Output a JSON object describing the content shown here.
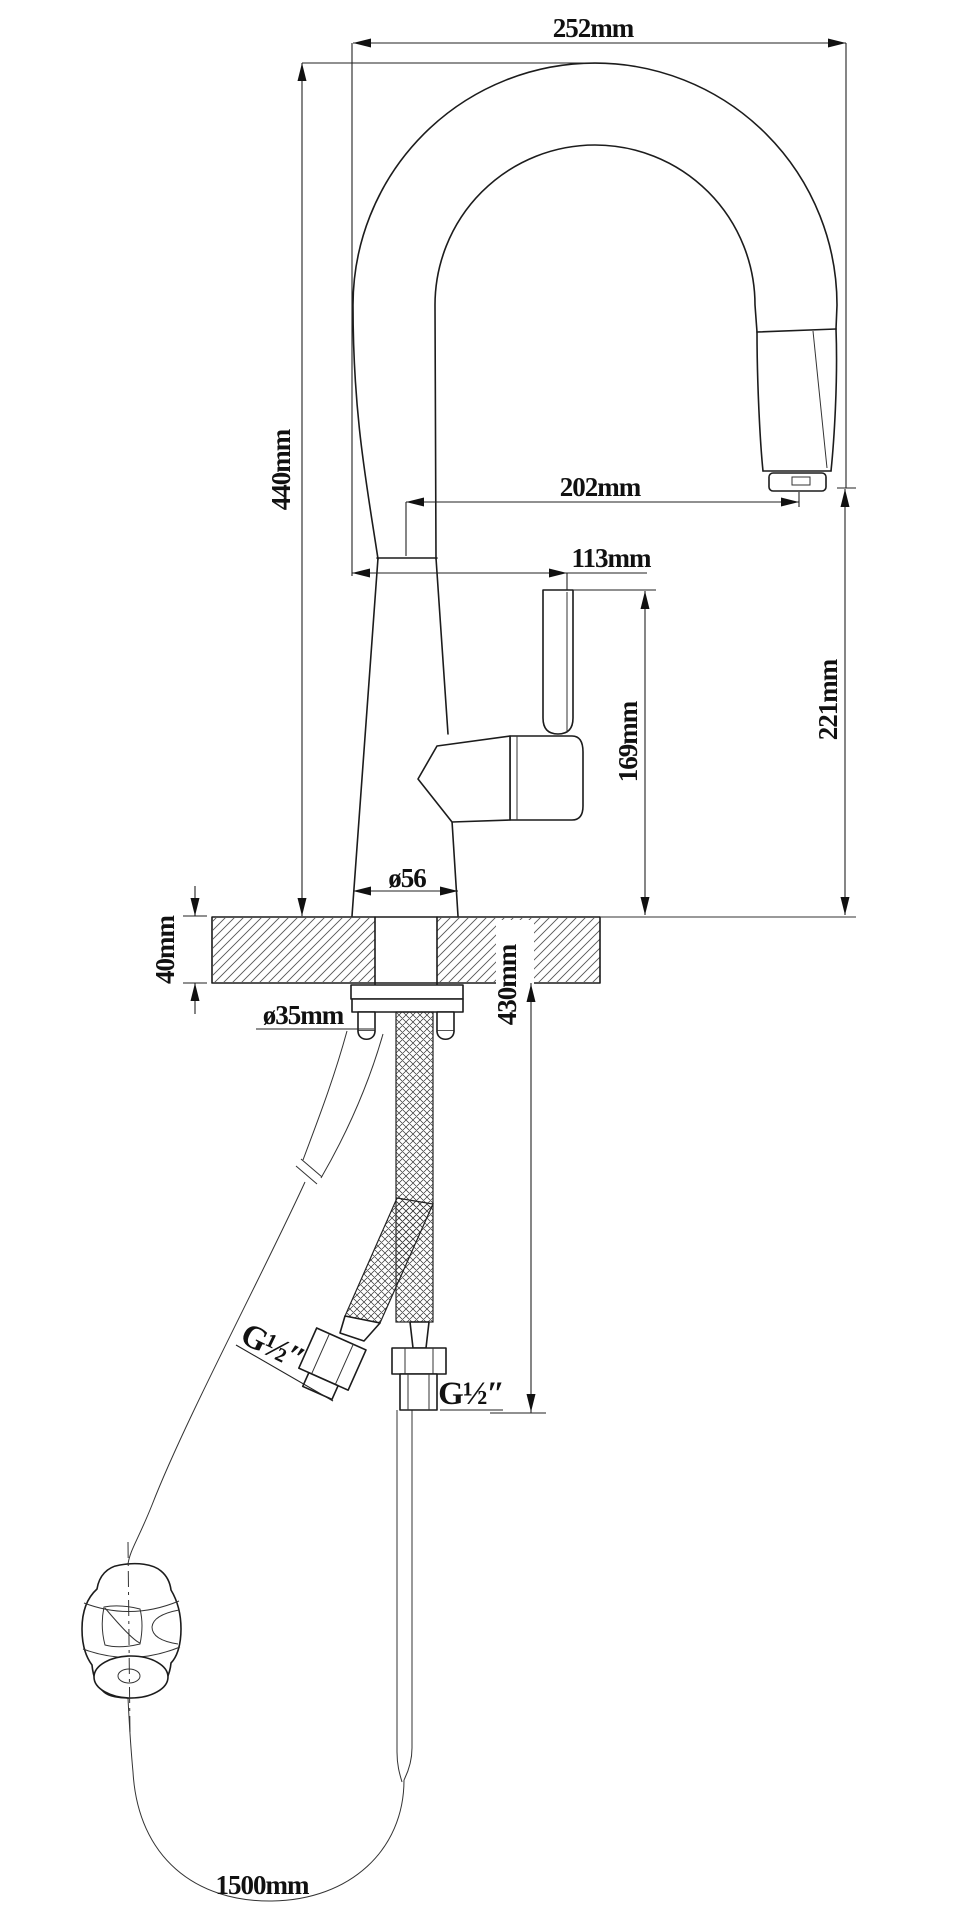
{
  "drawing": {
    "kind": "faucet installation dimension drawing",
    "labels": {
      "spout_reach": "252mm",
      "overall_height": "440mm",
      "outlet_reach": "202mm",
      "handle_reach": "113mm",
      "outlet_height": "221mm",
      "handle_height": "169mm",
      "base_diameter": "ø56",
      "counter_thickness": "40mm",
      "hole_diameter": "ø35mm",
      "hose_drop": "430mm",
      "thread_left": "G½″",
      "thread_right": "G½″",
      "hose_length": "1500mm"
    }
  }
}
